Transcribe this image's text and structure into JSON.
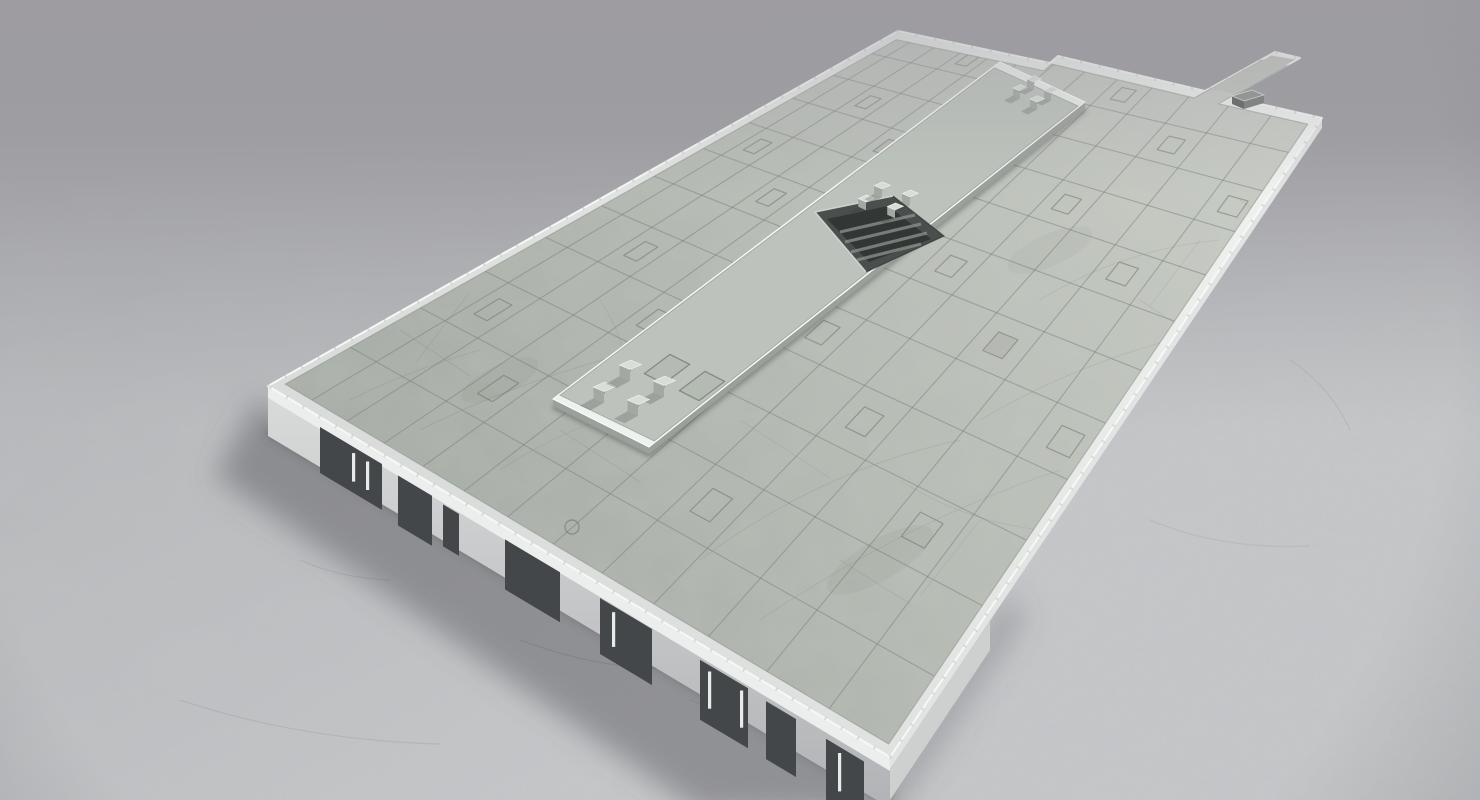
{
  "scene": {
    "title": "3D render of a flat-roof concrete building model on a concrete floor",
    "view": "high-angle three-quarter aerial view",
    "background": {
      "top": "#96959a",
      "mid": "#a8a8ac",
      "bottom": "#b9babd",
      "fog": "rgba(164,163,168,0.55)"
    },
    "floor": {
      "far": "#b0b2b5",
      "near": "#c4c6c8",
      "speckle": "#7c7f83",
      "crack": "#6e7174"
    },
    "building": {
      "parapet": {
        "fill_light": "#f0f2f0",
        "fill_dark": "#d9dcda",
        "highlight": "#f8faf9",
        "blotch": "#a9afa9"
      },
      "roof": {
        "near": "#a8aea7",
        "far": "#c8ccc5",
        "grid_line": "#78807a",
        "square_line": "#6f776f",
        "square_count": 26
      },
      "platform": {
        "rim": "#eef1ee",
        "field": "#bdc3bc",
        "seam": "#8d938d",
        "side": "#9aa09a",
        "shadow": "rgba(60,66,60,0.4)"
      },
      "hatch": {
        "frame": "#4a4f4d",
        "pit": "#323634",
        "streaks": "#8f948f",
        "edge_highlight": "#d3d7d4",
        "edge_dark": "#24282 6"
      },
      "vents": {
        "top": "#d9ddd8",
        "left": "#7f857e",
        "right": "#a2a8a2",
        "count": 12,
        "clusters": [
          4,
          4,
          4
        ]
      },
      "facade": {
        "fascia": "#eceeed",
        "wall_light": "#d8d9d9",
        "wall_dark": "#b2b3b6",
        "panel": "#43474a",
        "door_frame": "#e9ebeb",
        "panel_count": 8
      },
      "walkway_block": {
        "top": "#8b918d",
        "front": "#595e5c",
        "side": "#747977"
      },
      "shadow": "rgba(92,94,98,0.5)"
    }
  }
}
